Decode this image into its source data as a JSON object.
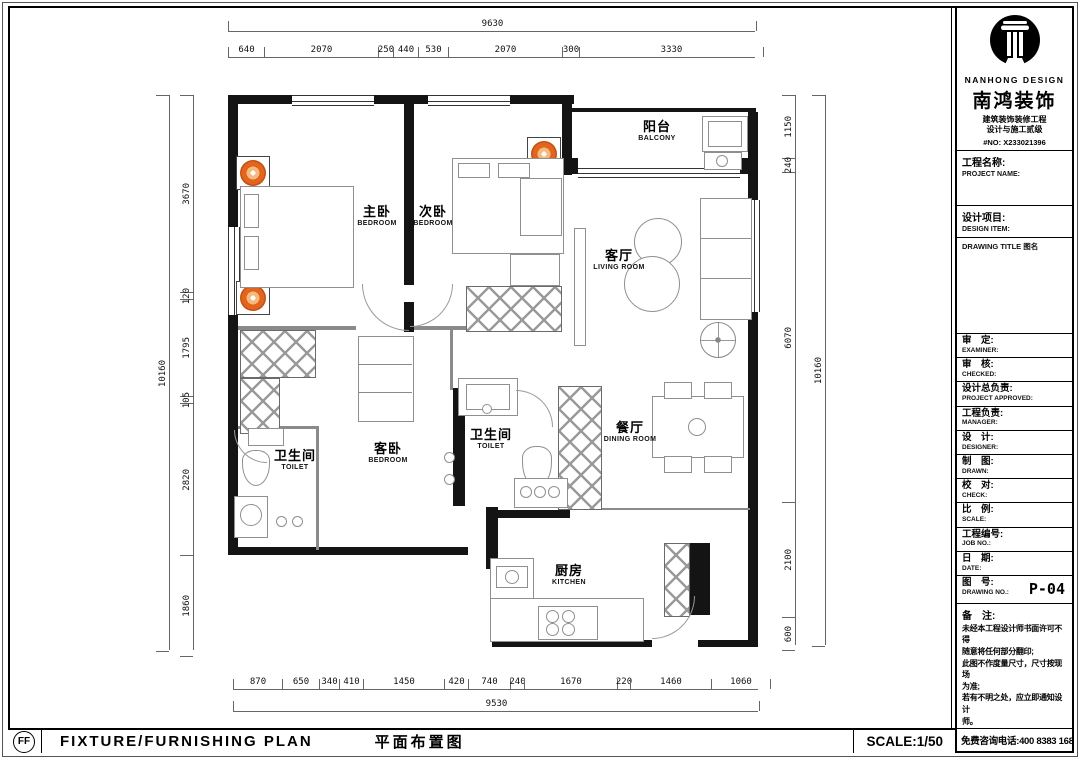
{
  "title_block": {
    "brand_en": "NANHONG DESIGN",
    "brand_cn": "南鸿装饰",
    "cert_line1": "建筑装饰装修工程",
    "cert_line2": "设计与施工贰级",
    "cert_no": "#NO: X233021396",
    "project_name_cn": "工程名称:",
    "project_name_en": "PROJECT NAME:",
    "design_item_cn": "设计项目:",
    "design_item_en": "DESIGN ITEM:",
    "drawing_title_label": "DRAWING TITLE 图名",
    "rows": [
      {
        "cn": "审　定:",
        "en": "EXAMINER:",
        "value": ""
      },
      {
        "cn": "审　核:",
        "en": "CHECKED:",
        "value": ""
      },
      {
        "cn": "设计总负责:",
        "en": "PROJECT APPROVED:",
        "value": ""
      },
      {
        "cn": "工程负责:",
        "en": "MANAGER:",
        "value": ""
      },
      {
        "cn": "设　计:",
        "en": "DESIGNER:",
        "value": ""
      },
      {
        "cn": "制　图:",
        "en": "DRAWN:",
        "value": ""
      },
      {
        "cn": "校　对:",
        "en": "CHECK:",
        "value": ""
      },
      {
        "cn": "比　例:",
        "en": "SCALE:",
        "value": ""
      },
      {
        "cn": "工程编号:",
        "en": "JOB NO.:",
        "value": ""
      },
      {
        "cn": "日　期:",
        "en": "DATE:",
        "value": ""
      },
      {
        "cn": "图　号:",
        "en": "DRAWING NO.:",
        "value": "P-04"
      }
    ],
    "remarks_label": "备　注:",
    "remarks": "未经本工程设计师书面许可不得\n随意将任何部分翻印;\n此图不作度量尺寸，尺寸按现场\n为准;\n若有不明之处，应立即通知设计\n师。",
    "remarks_small": "本设计图纸版权归设计师所有。",
    "phone": "免费咨询电话:400 8383 168"
  },
  "footer": {
    "code": "FF",
    "title_en": "FIXTURE/FURNISHING PLAN",
    "title_cn": "平面布置图",
    "scale": "SCALE:1/50"
  },
  "plan": {
    "rooms": [
      {
        "cn": "主卧",
        "en": "BEDROOM"
      },
      {
        "cn": "次卧",
        "en": "BEDROOM"
      },
      {
        "cn": "阳台",
        "en": "BALCONY"
      },
      {
        "cn": "客厅",
        "en": "LIVING ROOM"
      },
      {
        "cn": "餐厅",
        "en": "DINING ROOM"
      },
      {
        "cn": "厨房",
        "en": "KITCHEN"
      },
      {
        "cn": "客卧",
        "en": "BEDROOM"
      },
      {
        "cn": "卫生间",
        "en": "TOILET"
      },
      {
        "cn": "卫生间",
        "en": "TOILET"
      }
    ],
    "dims": {
      "top_total": "9630",
      "top": [
        "640",
        "2070",
        "250",
        "440",
        "530",
        "2070",
        "300",
        "3330"
      ],
      "bottom_total": "9530",
      "bottom": [
        "870",
        "650",
        "340",
        "410",
        "1450",
        "420",
        "740",
        "240",
        "1670",
        "220",
        "1460",
        "1060"
      ],
      "left_total": "10160",
      "left": [
        "3670",
        "120",
        "1795",
        "105",
        "2820",
        "1860"
      ],
      "right_total": "10160",
      "right": [
        "1150",
        "240",
        "6070",
        "2100",
        "600"
      ]
    },
    "colors": {
      "accent_orange": "#e2651f",
      "wall": "#141414"
    }
  }
}
